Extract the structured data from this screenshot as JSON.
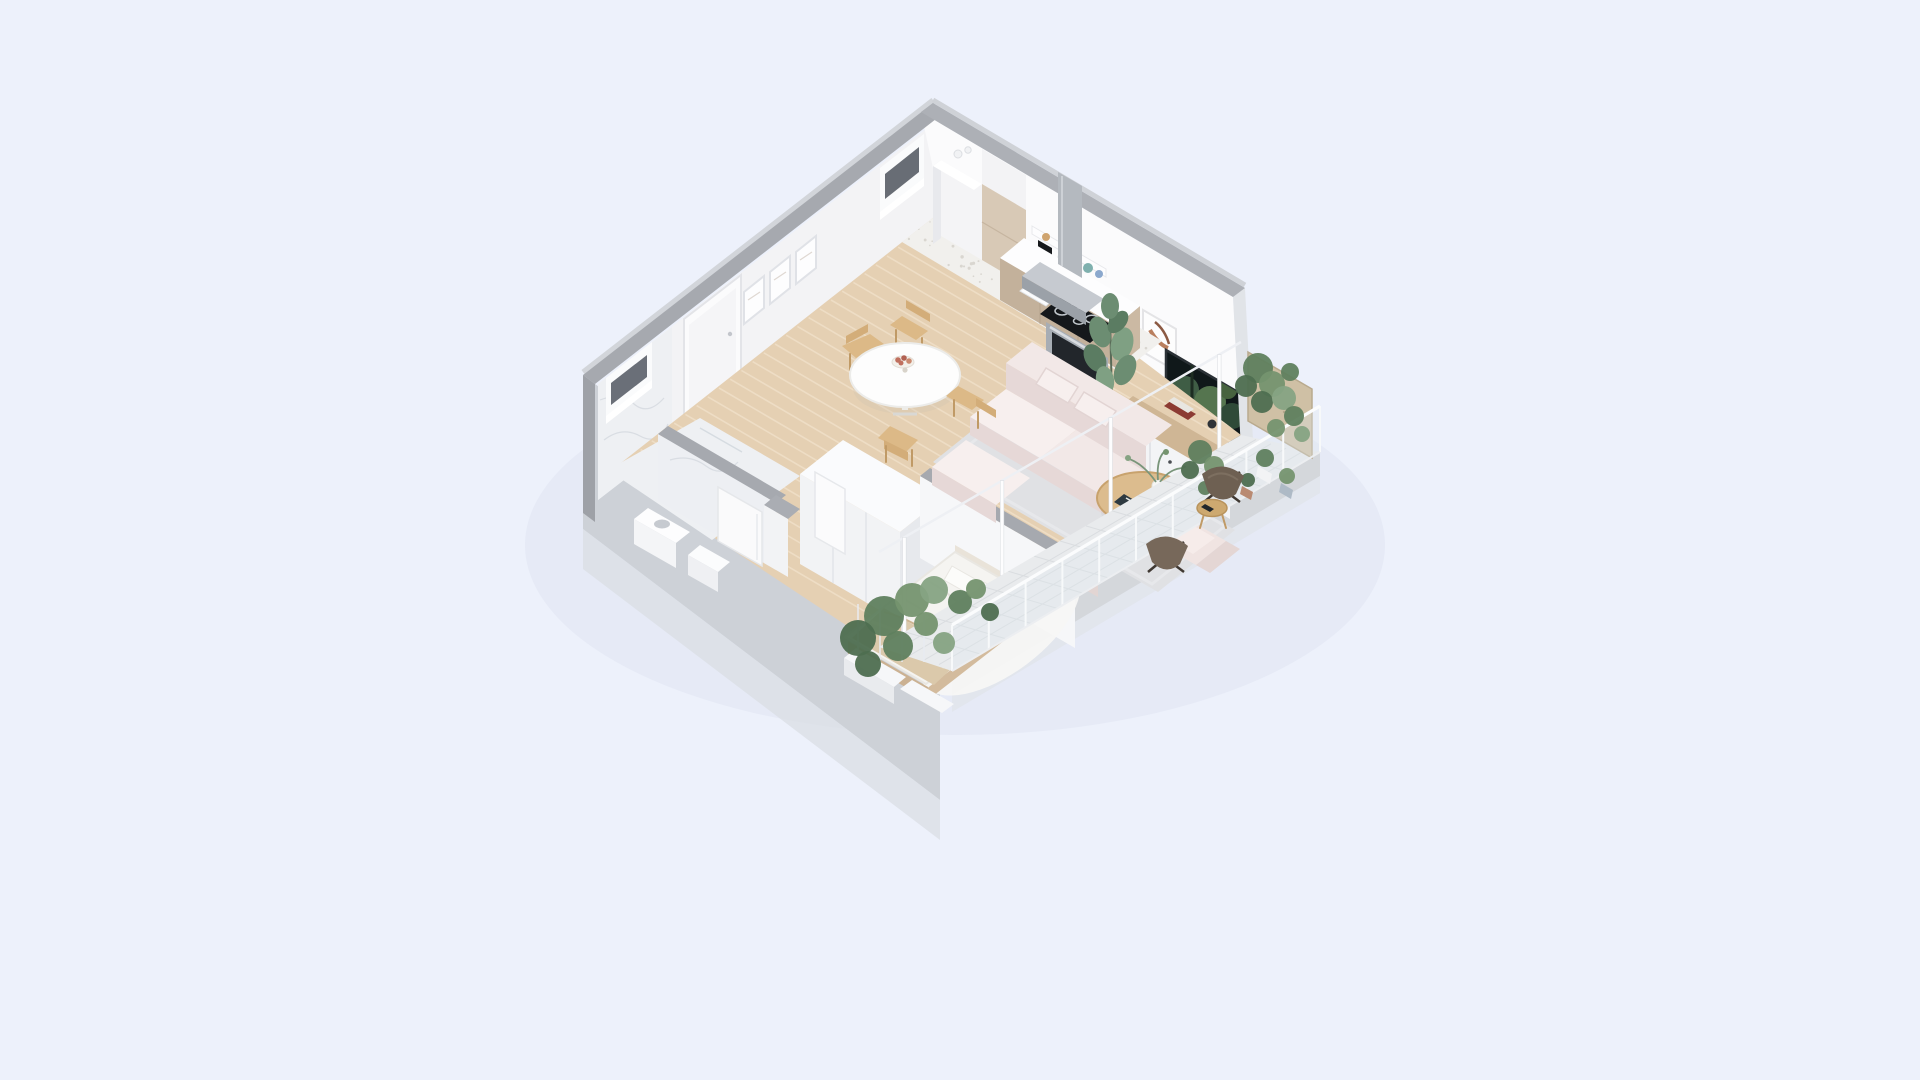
{
  "scene": {
    "kind": "isometric-3d-apartment-floorplan-render",
    "background": "#edf1fb",
    "projection": "axonometric, top corner at (933,103), left slope 0.78, right slope 0.585"
  },
  "palette": {
    "bg": "#edf1fb",
    "shadow": "#e1e6f3",
    "wallTop": "#adb0b6",
    "wallTopL": "#a6a9af",
    "wallOuter": "#cdd1d7",
    "wallOuterLow": "#d9dde3",
    "wallInnerL": "#f3f3f5",
    "wallInnerR": "#fbfbfc",
    "marble": "#eef0f3",
    "veinCol": "#c9cdd6",
    "wood": "#e5d0b3",
    "woodGap": "#f1e2cb",
    "woodWarm": "#cfb695",
    "terrazzo": "#f1f0ed",
    "speckle": "#d9d6d0",
    "cabinet": "#c3b19b",
    "cabinetDark": "#cbb9a3",
    "cabinetLight": "#d8c9b6",
    "counter": "#fdfdfe",
    "steel": "#b4b9bf",
    "steelDark": "#9ba1a8",
    "applianceBlack": "#15181b",
    "sofa": "#f2e8e7",
    "sofaShade": "#e6d8d7",
    "sofaLight": "#f7efee",
    "rugGray": "#e0e1e4",
    "rugWhite": "#f7f7f5",
    "tableGold": "#dcbc8e",
    "chairWood": "#dcb987",
    "plant1": "#5f7f5e",
    "plant2": "#75946f",
    "plant3": "#4e6e50",
    "plant4": "#86a383",
    "leather": "#6e6052",
    "plywood": "#cfc0a5",
    "balconyTile": "#e9ebed",
    "tv": "#10181a",
    "blanket": "#dbc9ab"
  },
  "rooms": [
    {
      "name": "kitchen",
      "items": [
        "tall-cabinet-white",
        "tall-cabinet-beige",
        "open-shelf",
        "toaster",
        "counter-sink",
        "cooktop",
        "oven",
        "range-hood",
        "terrazzo-floor",
        "window"
      ]
    },
    {
      "name": "dining",
      "items": [
        "round-white-table",
        "fruit-bowl",
        "wood-chair-x4",
        "wood-plank-floor"
      ]
    },
    {
      "name": "living",
      "items": [
        "pink-modular-sofa",
        "pillows",
        "ottoman",
        "gray-rug",
        "gold-oval-coffee-table",
        "book",
        "vase-plant",
        "tv",
        "tv-console",
        "books-stack",
        "art-frame",
        "fiddle-leaf-plant",
        "pink-armchair",
        "pouf"
      ]
    },
    {
      "name": "hallway",
      "items": [
        "entry-door",
        "picture-frames-x3",
        "wood-plank-floor"
      ]
    },
    {
      "name": "bathroom",
      "items": [
        "marble-walls",
        "window",
        "vanity-sink",
        "low-cabinet",
        "ajar-door",
        "marble-floor"
      ]
    },
    {
      "name": "bedroom",
      "items": [
        "double-bed",
        "pillows-x2",
        "beige-blanket",
        "wood-bed-frame",
        "white-rug",
        "wardrobe-divider",
        "partition-wall",
        "ajar-door"
      ]
    },
    {
      "name": "balcony",
      "items": [
        "tile-floor",
        "white-railing",
        "glass-wall-posts",
        "plywood-privacy-screen",
        "hanging-plants",
        "butterfly-chair-x2",
        "round-side-table",
        "phone",
        "plant-pots",
        "planter-boxes",
        "trellis"
      ]
    }
  ],
  "render": {
    "planks": {
      "count": 30,
      "x0": 943,
      "y0": 212,
      "stepX": -11.2,
      "stepY": 8.8,
      "dirX": 400,
      "dirY": 234,
      "color": "#f1e2cb",
      "width": 1.6,
      "opacity": 0.75
    },
    "speckles": {
      "count": 70,
      "seed": 7,
      "color": "#d9d6d0",
      "rMin": 0.7,
      "rMax": 1.8,
      "quad": [
        [
          943,
          210
        ],
        [
          1162,
          341
        ],
        [
          1121,
          373
        ],
        [
          902,
          242
        ]
      ]
    },
    "balconyTileLines": {
      "colA": "#dadde0",
      "uCount": 4,
      "vCount": 13,
      "inner": [
        [
          1241,
          435
        ],
        [
          879,
          647
        ]
      ],
      "depthX": 75,
      "depthY": 22
    },
    "railing": {
      "posts": 10,
      "from": [
        1320,
        452
      ],
      "to": [
        952,
        671
      ],
      "height": 46,
      "postColor": "#f7f9fa",
      "barColor": "#fbfcfd"
    },
    "glassPosts": {
      "t": [
        0.06,
        0.36,
        0.66,
        0.93
      ],
      "from": [
        1241,
        437
      ],
      "to": [
        879,
        647
      ],
      "height": 95,
      "color": "#fdfdfe"
    },
    "trellis": {
      "xs": [
        858,
        880,
        902,
        924
      ],
      "yBase": 662,
      "height": 58,
      "color": "#e8ebf0"
    },
    "plantClusters": [
      {
        "name": "hanging-plants-right",
        "circles": [
          [
            1258,
            368,
            15
          ],
          [
            1272,
            384,
            13
          ],
          [
            1262,
            402,
            11
          ],
          [
            1284,
            398,
            12
          ],
          [
            1294,
            416,
            10
          ],
          [
            1276,
            428,
            9
          ],
          [
            1246,
            386,
            11
          ],
          [
            1302,
            434,
            8
          ],
          [
            1290,
            372,
            9
          ]
        ]
      },
      {
        "name": "hanging-plants-mid",
        "circles": [
          [
            1200,
            452,
            12
          ],
          [
            1214,
            466,
            10
          ],
          [
            1190,
            470,
            9
          ],
          [
            1224,
            482,
            8
          ],
          [
            1205,
            488,
            7
          ]
        ]
      },
      {
        "name": "planter-greens",
        "circles": [
          [
            884,
            616,
            20
          ],
          [
            912,
            600,
            17
          ],
          [
            858,
            638,
            18
          ],
          [
            934,
            590,
            14
          ],
          [
            898,
            646,
            15
          ],
          [
            926,
            624,
            12
          ],
          [
            868,
            664,
            13
          ],
          [
            944,
            643,
            11
          ],
          [
            960,
            602,
            12
          ],
          [
            976,
            589,
            10
          ],
          [
            990,
            612,
            9
          ]
        ]
      },
      {
        "name": "pot-greens",
        "circles": [
          [
            1265,
            458,
            9
          ],
          [
            1287,
            476,
            8
          ],
          [
            1248,
            480,
            7
          ]
        ]
      }
    ],
    "plantColors": [
      "#5f7f5e",
      "#75946f",
      "#4e6e50",
      "#86a383"
    ]
  }
}
